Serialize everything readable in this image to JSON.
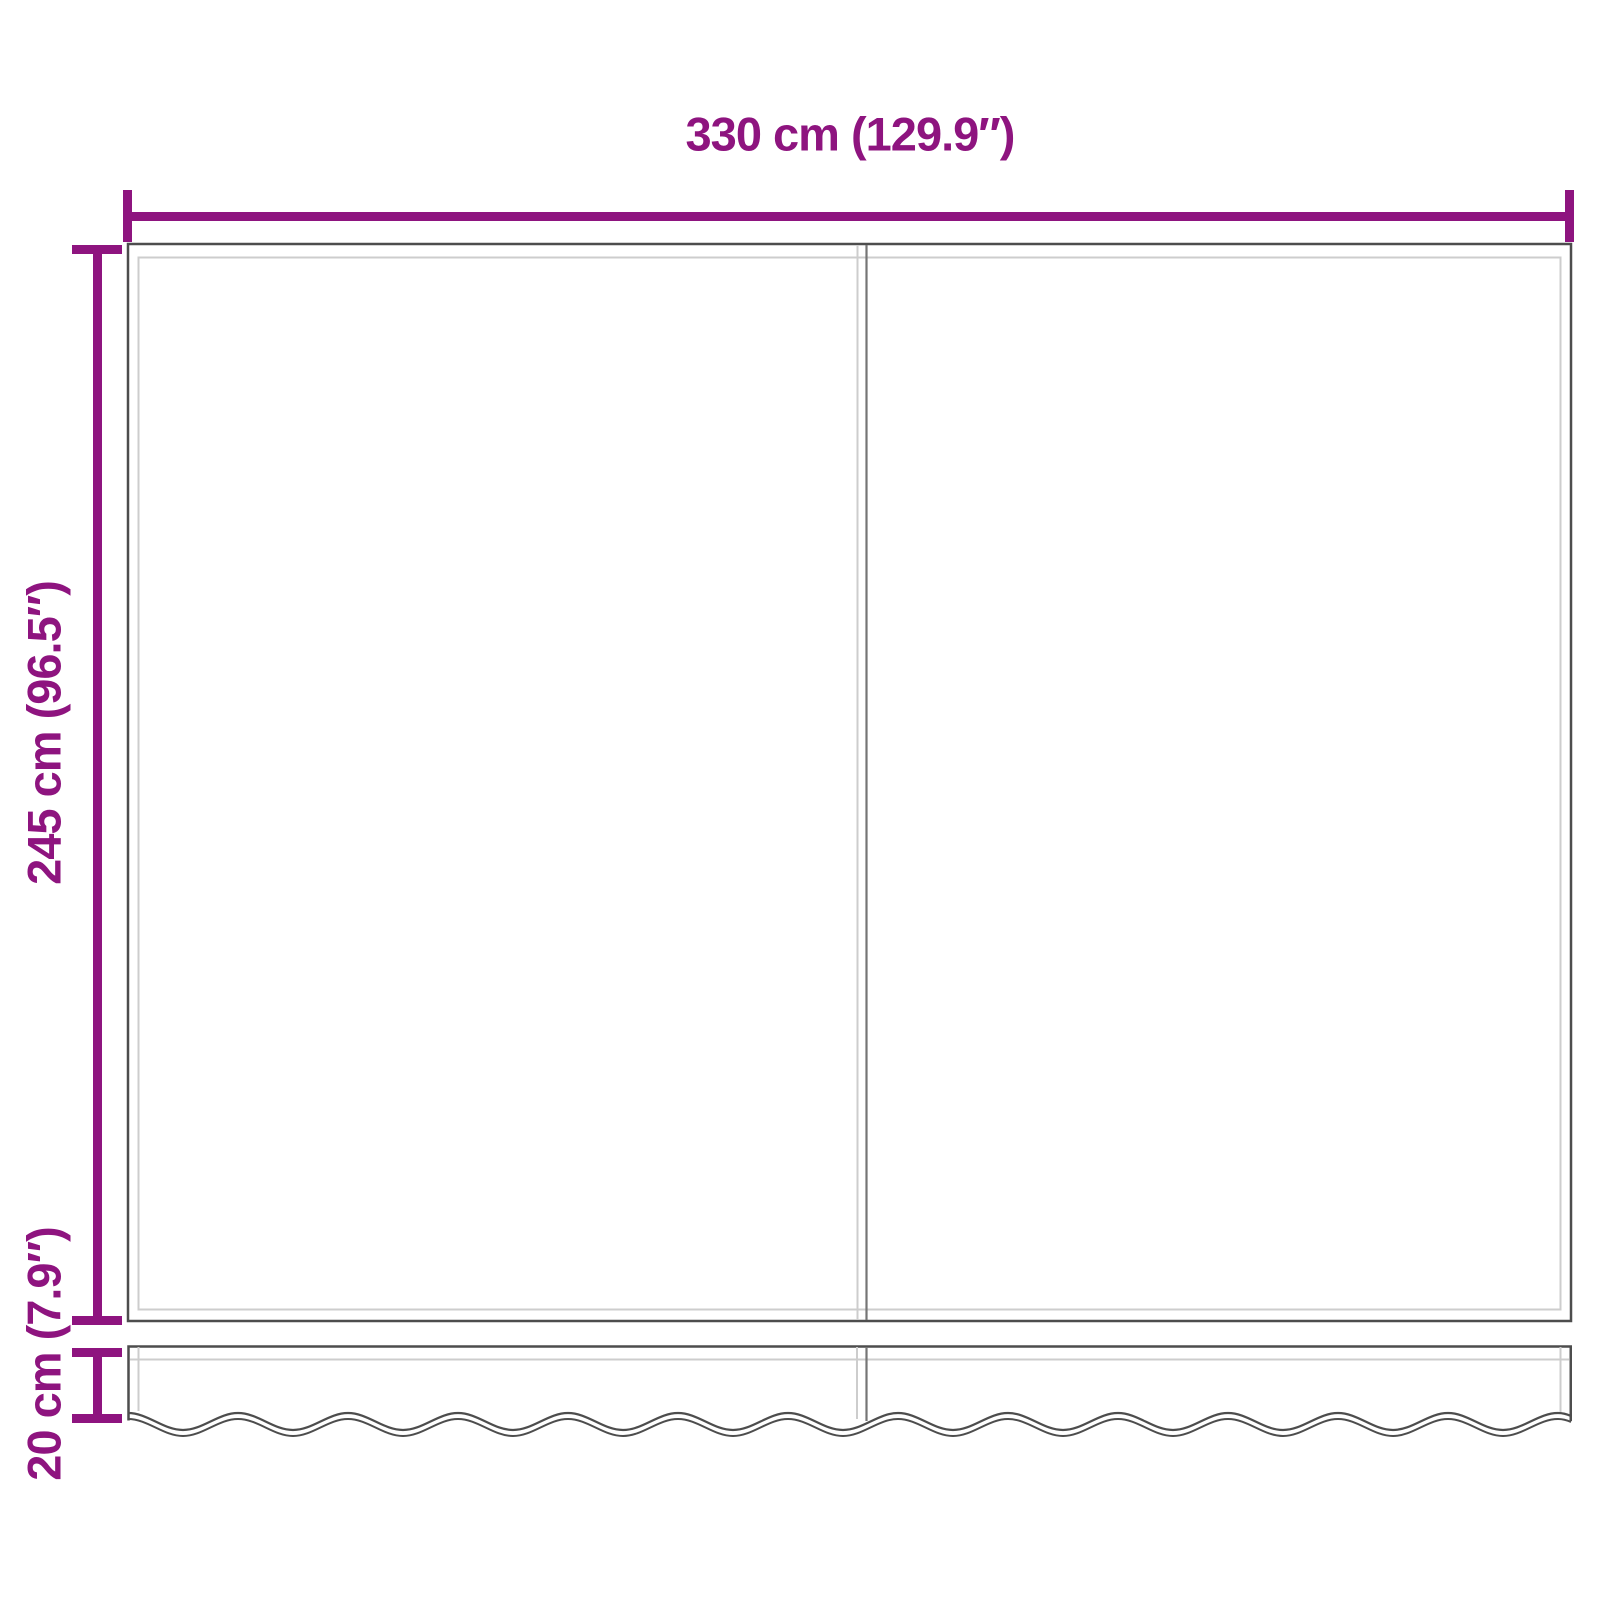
{
  "diagram": {
    "width_label": "330 cm (129.9″)",
    "height_label": "245 cm (96.5″)",
    "valance_height_label": "20 cm (7.9″)"
  },
  "colors": {
    "dimension-color": "#8E147F",
    "outline-dark": "#4D4D4D",
    "outline-mid": "#757575",
    "outline-light": "#CDCDCD",
    "background": "#FFFFFF"
  }
}
